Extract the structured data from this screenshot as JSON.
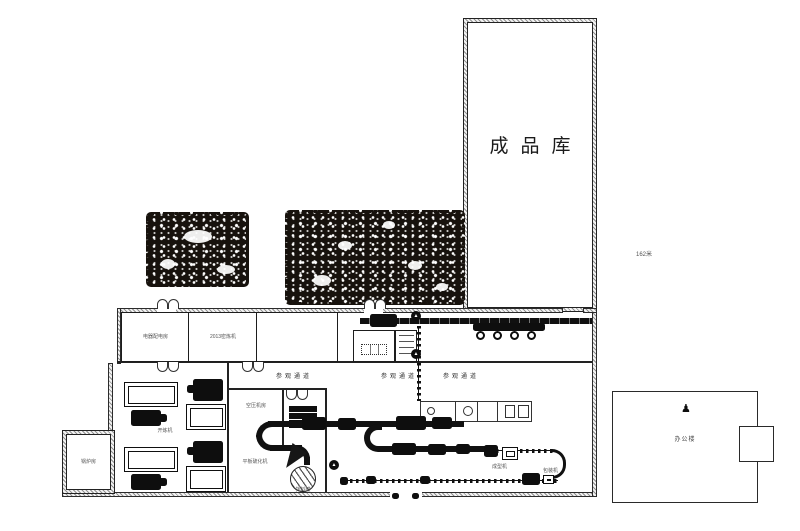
{
  "colors": {
    "line": "#1a1a1a",
    "background": "#ffffff"
  },
  "warehouse": {
    "label": "成品库"
  },
  "site": {
    "dimension": "162米"
  },
  "corridor": {
    "room_power": "电器配电房",
    "room_mixer": "2013密炼机",
    "walkway_1": "参观通道",
    "walkway_2": "参观通道",
    "walkway_3": "参观通道"
  },
  "workshop": {
    "annex": "锅炉房",
    "mill_room": "开炼机",
    "compressor_room": "空压机房",
    "vulcanizer": "平板硫化机",
    "tank": "拌料罐",
    "machine_forming": "成型机",
    "machine_packing": "包装机"
  },
  "office": {
    "label": "办公楼"
  },
  "icons": {
    "direction_arrow": "▲",
    "person": "♟"
  }
}
